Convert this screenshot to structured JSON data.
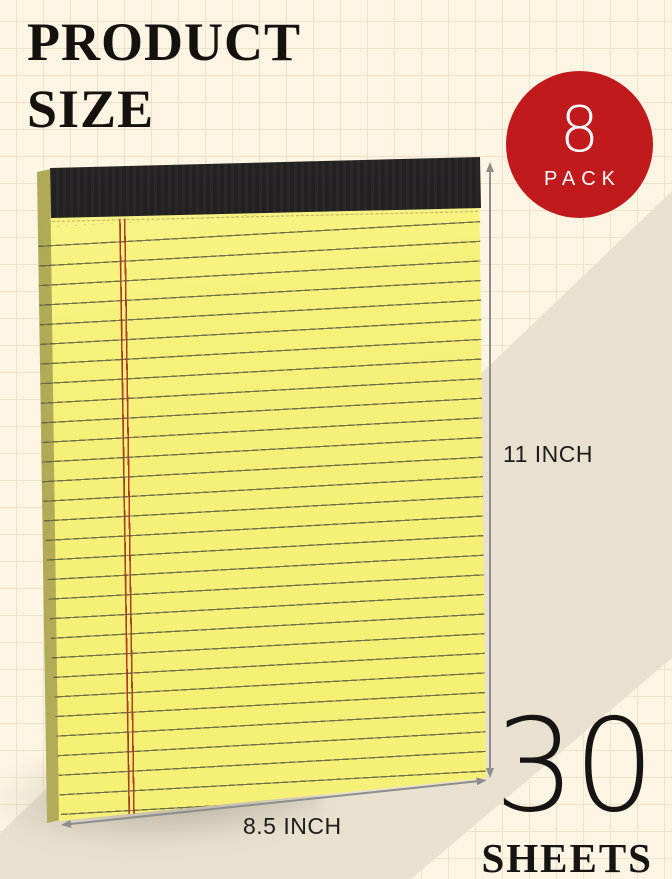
{
  "title": {
    "line1": "PRODUCT",
    "line2": "SIZE"
  },
  "badge": {
    "count": "8",
    "pack_label": "PACK",
    "color": "#c01a1d",
    "text_color": "#ffffff"
  },
  "dims": {
    "height_label": "11 INCH",
    "width_label": "8.5 INCH",
    "arrow_color": "#8d8d8d"
  },
  "sheets": {
    "count": "30",
    "label": "SHEETS"
  },
  "notepad": {
    "paper_color": "#f7f17b",
    "side_edge_color": "#ccc66a",
    "binding_color": "#1d1b1c",
    "rule_line_color": "#5c5c3e",
    "margin_line_color": "#a93a28"
  },
  "background": {
    "base_color": "#fcf5e3",
    "grid_line_color": "#f0e2ca",
    "band_color": "#e9e1d0"
  }
}
